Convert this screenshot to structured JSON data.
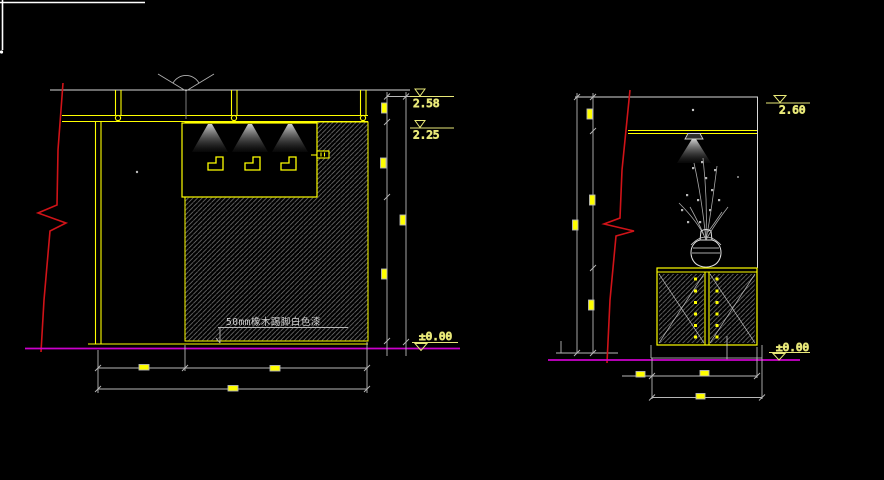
{
  "viewport": {
    "background": "#000000"
  },
  "palette": {
    "line_yellow": "#ffff00",
    "dimension_white": "#b8b8b8",
    "break_line_red": "#d01318",
    "floor_magenta": "#cc00cc",
    "hatch_gray": "#6f6f6f",
    "level_text_yellow": "#e8e878",
    "note_text_gray": "#cfcfcf"
  },
  "left_elevation": {
    "levels": {
      "slab_top": "2.58",
      "ceiling": "2.25",
      "floor": "±0.00"
    },
    "skirting_note": "50mm橡木踢脚白色漆"
  },
  "right_elevation": {
    "levels": {
      "slab_top": "2.60",
      "floor": "±0.00"
    }
  }
}
